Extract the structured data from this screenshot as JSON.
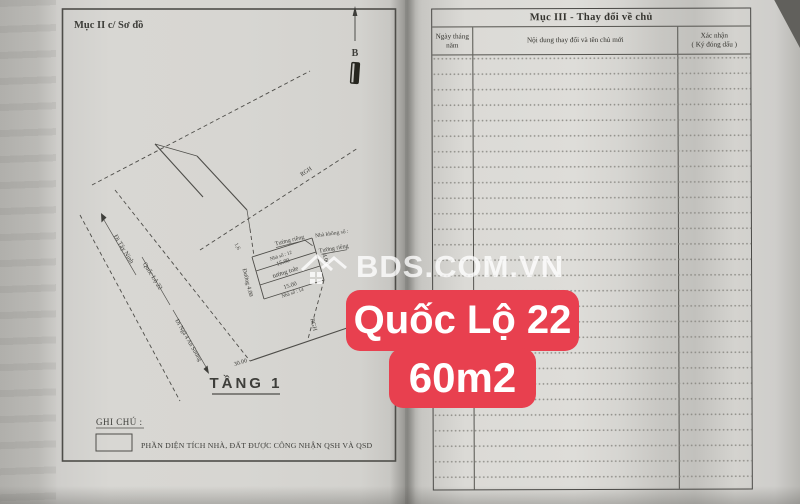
{
  "overlay": {
    "watermark_text": "BDS.COM.VN",
    "badge_line1": "Quốc Lộ 22",
    "badge_line2": "60m2",
    "badge_color": "#e8404f"
  },
  "left_page": {
    "section_title": "Mục II c/ Sơ đồ",
    "compass_label": "B",
    "diagram": {
      "to_tay_ninh": "Đi Tây Ninh",
      "road_name": "Quốc Lộ 22",
      "to_an_suong": "Đi Ngã 4 An Sương",
      "boundary_top": "RGH",
      "boundary_bottom": "RGH",
      "offset_dim": "1,6",
      "house_12": "Nhà số : 12",
      "len_top": "15.00",
      "wall_top": "Tường riêng",
      "wall_tole": "tường tole",
      "len_bottom": "15.00",
      "house_14": "Nhà số : 14",
      "house_no_number": "Nhà không số :",
      "wall_right": "Tường riêng",
      "width_right": "4.00",
      "alley": "Đường 4.00",
      "frontage": "30.00",
      "floor": "TẦNG 1"
    },
    "notes_title": "GHI CHÚ :",
    "notes_legend": "PHẦN DIỆN TÍCH NHÀ, ĐẤT ĐƯỢC CÔNG NHẬN QSH VÀ QSD"
  },
  "right_page": {
    "table_title": "Mục III - Thay đổi về chủ",
    "col_date_l1": "Ngày tháng",
    "col_date_l2": "năm",
    "col_content": "Nội dung thay đổi và tên chủ mới",
    "col_confirm_l1": "Xác nhận",
    "col_confirm_l2": "( Ký đóng dấu )"
  }
}
